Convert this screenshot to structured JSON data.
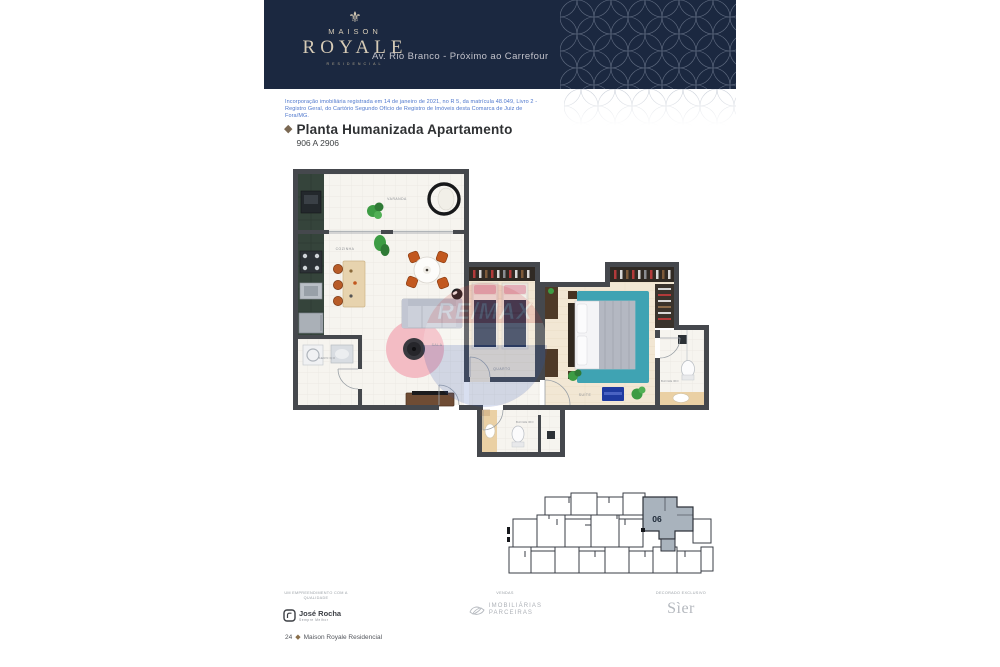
{
  "header": {
    "logo": {
      "ornament": "⚜",
      "line1": "MAISON",
      "line2": "ROYALE",
      "line3": "RESIDENCIAL"
    },
    "tagline": "Av. Rio Branco - Próximo ao Carrefour"
  },
  "legal_note": "Incorporação imobiliária registrada em 14 de janeiro de 2021, no R 5, da matrícula 48.049, Livro 2 - Registro Geral, do Cartório Segundo Ofício de Registro de Imóveis desta Comarca de Juiz de Fora/MG.",
  "section": {
    "bullet": "◆",
    "title": "Planta Humanizada Apartamento",
    "subtitle": "906 A 2906"
  },
  "plan": {
    "rooms": {
      "varanda": "VARANDA",
      "cozinha": "COZINHA",
      "sala": "SALA",
      "servico": "SERVIÇO",
      "quarto": "QUARTO",
      "suite": "SUÍTE",
      "banheiro_suite": "BANHEIRO",
      "banheiro_social": "BANHEIRO"
    },
    "watermark": "RE/MAX"
  },
  "keyplan": {
    "unit": "06"
  },
  "footer": {
    "developer_caption_line1": "UM EMPREENDIMENTO COM A",
    "developer_caption_line2": "QUALIDADE",
    "developer_logo": "José Rocha",
    "developer_logo_tagline": "Sempre Melhor",
    "sales_caption": "VENDAS",
    "sales_logo_line1": "IMOBILIÁRIAS",
    "sales_logo_line2": "PARCEIRAS",
    "decor_caption": "DECORADO EXCLUSIVO",
    "decor_logo": "Sìer",
    "page_number": "24",
    "page_bullet": "◆",
    "page_brand": "Maison Royale Residencial"
  },
  "colors": {
    "header_navy": "#1b2840",
    "logo_cream": "#d6cbb6",
    "legal_blue": "#4d76cc",
    "accent_diamond": "#8a6f4b",
    "keyplan_highlight": "#a9b3bd"
  }
}
